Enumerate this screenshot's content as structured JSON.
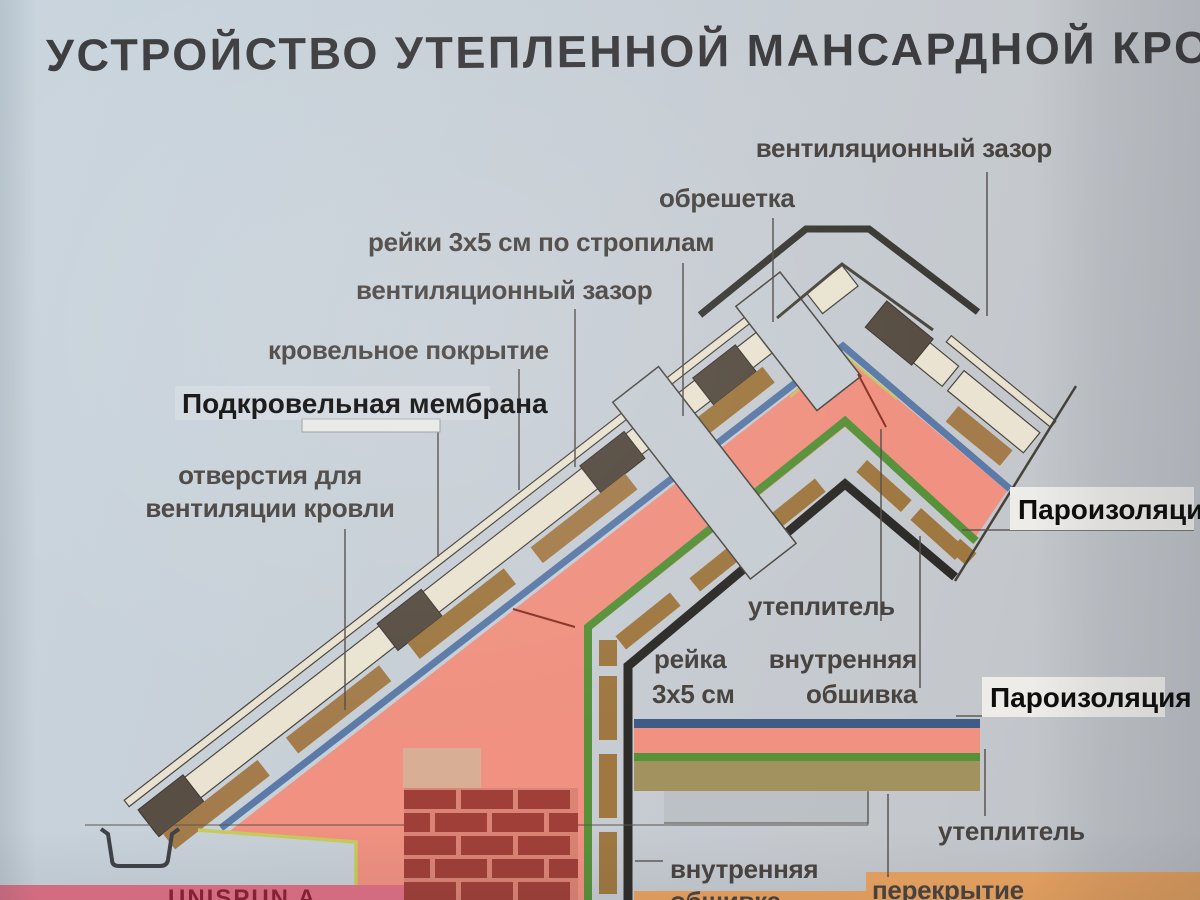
{
  "title": "УСТРОЙСТВО УТЕПЛЕННОЙ МАНСАРДНОЙ КРОВЛИ",
  "labels": {
    "vent_gap_top": "вентиляционный зазор",
    "obreshetka": "обрешетка",
    "reiki_stropila": "рейки 3х5 см по стропилам",
    "vent_gap_left": "вентиляционный зазор",
    "roof_covering": "кровельное покрытие",
    "membrane": "Подкровельная мембрана",
    "vent_holes_line1": "отверстия для",
    "vent_holes_line2": "вентиляции кровли",
    "vapor_barrier_upper": "Пароизоляция",
    "insulation_mid": "утеплитель",
    "reika_line1": "рейка",
    "reika_line2": "3х5 см",
    "inner_lining_mid_line1": "внутренняя",
    "inner_lining_mid_line2": "обшивка",
    "vapor_barrier_lower": "Пароизоляция",
    "insulation_bottom": "утеплитель",
    "inner_lining_bottom_line1": "внутренняя",
    "inner_lining_bottom_line2": "обшивка",
    "floor_slab": "перекрытие",
    "brand": "UNISPUN A"
  },
  "colors": {
    "background": "#c7ced5",
    "title_text": "#3d3c3e",
    "label_text": "#494440",
    "plank_cream": "#eae3d0",
    "batten_brown": "#a57c49",
    "block_dark": "#584e43",
    "membrane_blue": "#5a7aa8",
    "insulation_pink": "#f29080",
    "vapor_green": "#569339",
    "inner_lining_black": "#2e2c28",
    "ceiling_blue": "#3d5c88",
    "ceiling_olive": "#a2925e",
    "brick_red": "#a23e37",
    "brick_mortar": "#dd8273",
    "brand_band_pink": "#e26f85",
    "brand_text_red": "#8e2033",
    "bottom_band_orange": "#eba35e",
    "label_box_white": "#edece9",
    "accent_yellow": "#c6cb57"
  }
}
